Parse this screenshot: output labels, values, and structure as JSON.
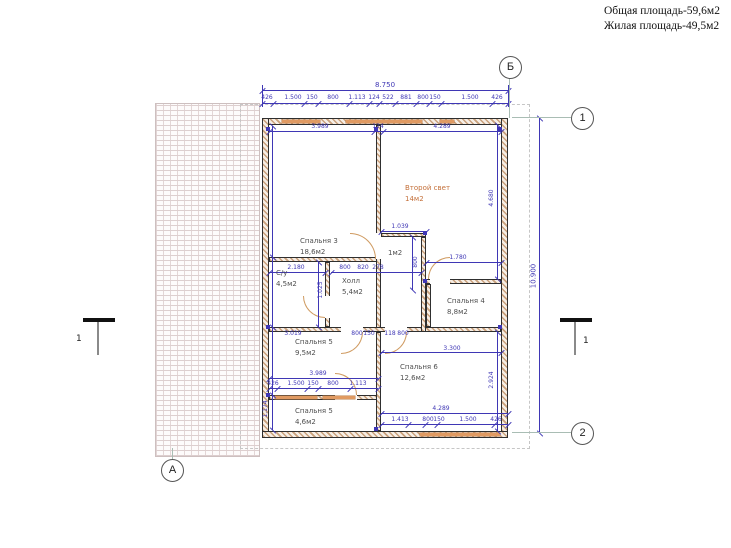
{
  "header": {
    "total_area": "Общая площадь-59,6м2",
    "living_area": "Жилая площадь-49,5м2"
  },
  "axes": {
    "top": "Б",
    "right_top": "1",
    "right_bottom": "2",
    "bottom_left": "А"
  },
  "section": {
    "left": "1",
    "right": "1"
  },
  "rooms": {
    "bedroom3": {
      "name": "Спальня 3",
      "area": "18,6м2"
    },
    "second_light": {
      "name": "Второй свет",
      "area": "14м2"
    },
    "closet": {
      "area": "1м2"
    },
    "bathroom": {
      "name": "С/у",
      "area": "4,5м2"
    },
    "hall": {
      "name": "Холл",
      "area": "5,4м2"
    },
    "bedroom4": {
      "name": "Спальня 4",
      "area": "8,8м2"
    },
    "bedroom5": {
      "name": "Спальня 5",
      "area": "9,5м2"
    },
    "bedroom6": {
      "name": "Спальня 6",
      "area": "12,6м2"
    },
    "bedroom5b": {
      "name": "Спальня 5",
      "area": "4,6м2"
    }
  },
  "dims": {
    "overall_width": "8.750",
    "overall_height": "10.900",
    "top_segments": [
      "426",
      "1.500",
      "150",
      "800",
      "1.113",
      "124",
      "522",
      "881",
      "800",
      "150",
      "1.500",
      "426"
    ],
    "top_inner": [
      "3.989",
      "124",
      "4.289"
    ],
    "su_width": "2.180",
    "su_height": "1.025",
    "hall_segments": [
      "800",
      "820",
      "278"
    ],
    "closet_width": "1.039",
    "closet_height": "800",
    "upper_right_width": "1.780",
    "upper_right_height": "4.680",
    "mid_row": [
      "3.019",
      "800",
      "150",
      "118",
      "800"
    ],
    "veranda_width": "3.989",
    "veranda_segments": [
      "426",
      "1.500",
      "150",
      "800",
      "1.113"
    ],
    "bedroom6_top_width": "3.300",
    "bedroom6_width": "4.289",
    "bottom_segments": [
      "1.413",
      "800",
      "150",
      "1.500",
      "426"
    ],
    "lower_right_height": "2.924",
    "lower_left_height": "1.174"
  },
  "colors": {
    "dimension": "#3f37b5",
    "window": "#e09a62",
    "accent_room": "#c4703a",
    "wall_hatch": "#c9a07c"
  }
}
